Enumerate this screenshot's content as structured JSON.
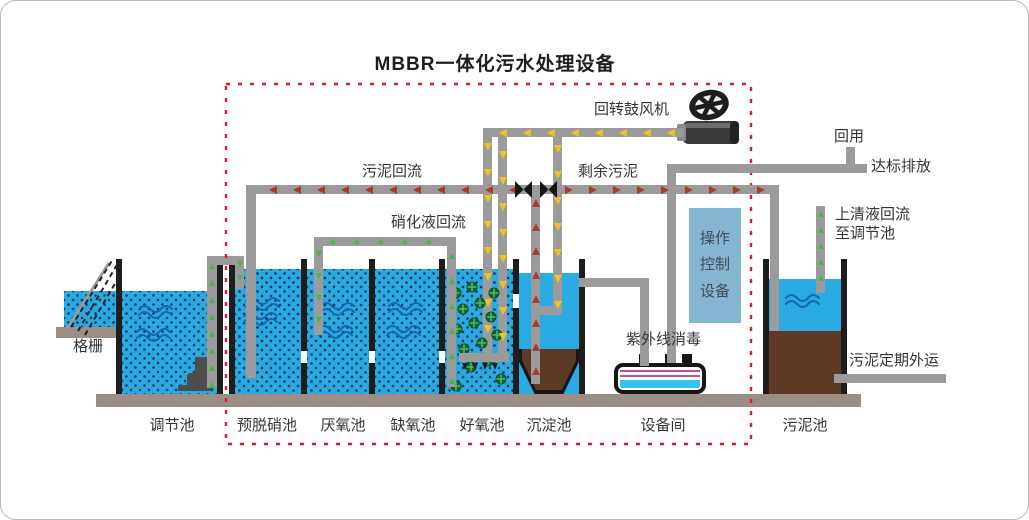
{
  "title": "MBBR一体化污水处理设备",
  "tanks": [
    {
      "label": "调节池"
    },
    {
      "label": "预脱硝池"
    },
    {
      "label": "厌氧池"
    },
    {
      "label": "缺氧池"
    },
    {
      "label": "好氧池"
    },
    {
      "label": "沉淀池"
    },
    {
      "label": "设备间"
    },
    {
      "label": "污泥池"
    }
  ],
  "labels": {
    "grid_screen": "格栅",
    "sludge_return": "污泥回流",
    "nitrification_return": "硝化液回流",
    "blower": "回转鼓风机",
    "excess_sludge": "剩余污泥",
    "reuse": "回用",
    "discharge": "达标排放",
    "supernatant_return": "上清液回流\n至调节池",
    "control_equipment": "操作\n控制\n设备",
    "uv": "紫外线消毒",
    "sludge_out": "污泥定期外运"
  },
  "colors": {
    "water": "#29aae2",
    "water_dot": "#173c60",
    "wave": "#1565ad",
    "wall": "#1d1d1d",
    "pipe": "#9b9b9b",
    "foundation": "#9c8e84",
    "sludge": "#5d3a26",
    "dash_red": "#e8152e",
    "arrow_yellow": "#f0c41e",
    "arrow_red": "#a93a2c",
    "arrow_green": "#49b251",
    "control_box": "#85b5d1",
    "uv_magenta": "#c0509e",
    "uv_cyan": "#35c3ea",
    "media_green": "#0e6b2d",
    "pump": "#4d4d4d",
    "text": "#353535"
  }
}
